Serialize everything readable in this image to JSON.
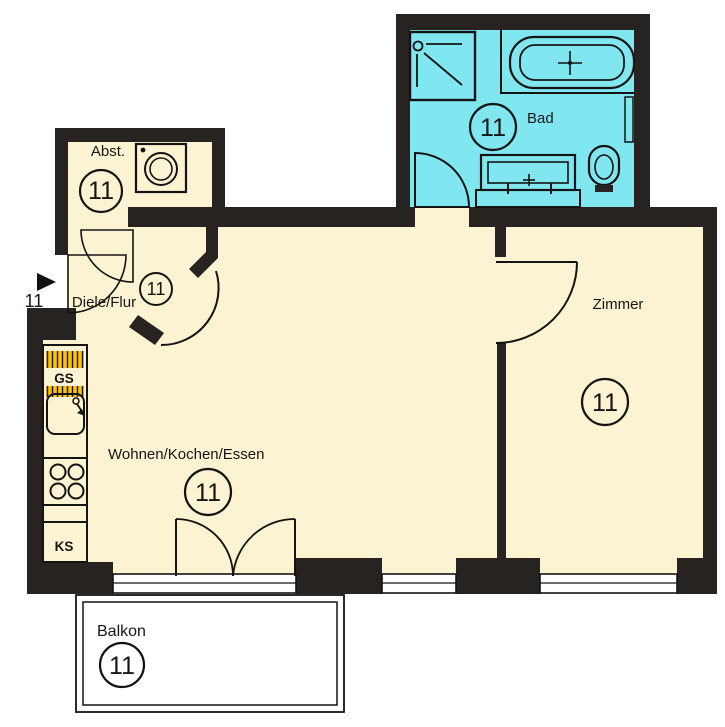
{
  "unit": {
    "number": "11"
  },
  "rooms": {
    "bad": {
      "label": "Bad"
    },
    "abstellraum": {
      "label": "Abst."
    },
    "diele": {
      "label": "Diele/Flur"
    },
    "wohnen": {
      "label": "Wohnen/Kochen/Essen"
    },
    "zimmer": {
      "label": "Zimmer"
    },
    "balkon": {
      "label": "Balkon"
    }
  },
  "kitchen": {
    "dishwasher_label": "GS",
    "fridge_label": "KS"
  },
  "entrance": {
    "number": "11"
  },
  "colors": {
    "room_fill": "#FBF3D2",
    "bath_fill": "#80E6F0",
    "kitchen_fill": "#FFC30B",
    "wall": "#262321"
  }
}
